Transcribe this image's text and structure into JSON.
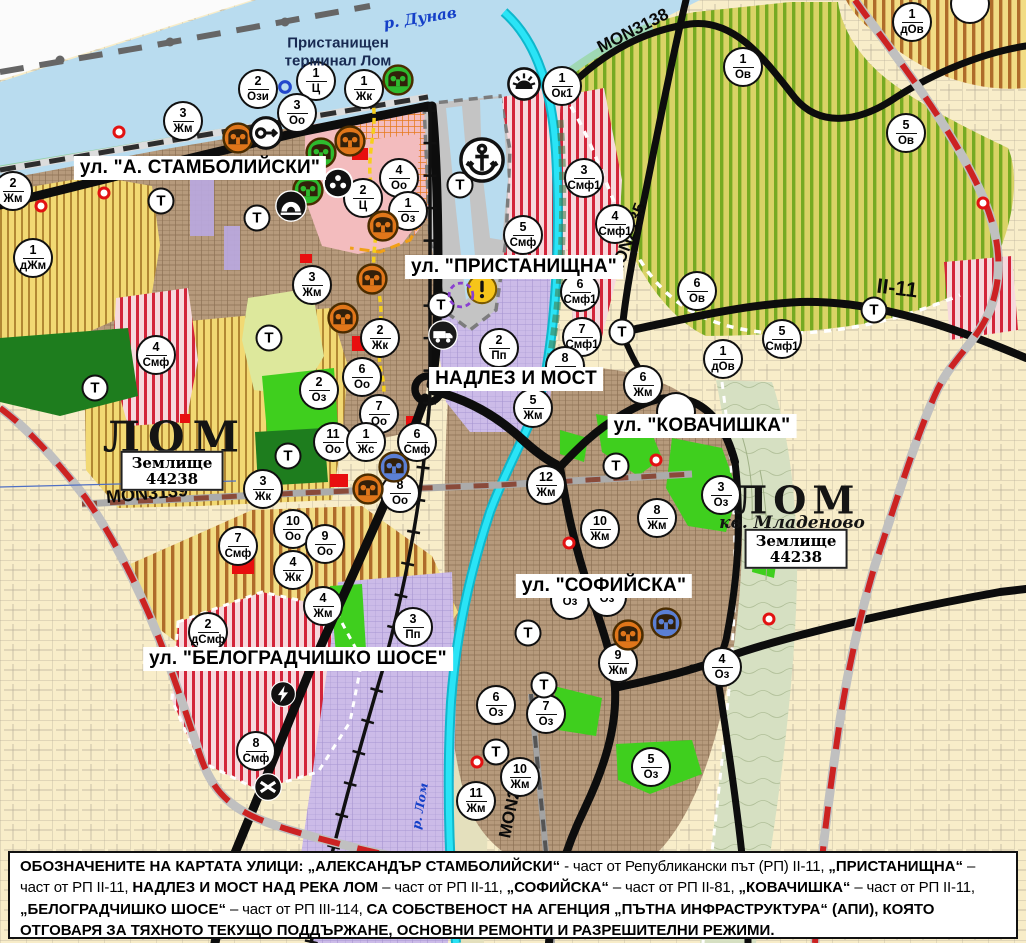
{
  "map": {
    "street_labels": [
      {
        "text": "ул. \"А. СТАМБОЛИЙСКИ\"",
        "x": 200,
        "y": 168
      },
      {
        "text": "ул. \"ПРИСТАНИЩНА\"",
        "x": 514,
        "y": 267
      },
      {
        "text": "НАДЛЕЗ И МОСТ",
        "x": 516,
        "y": 379
      },
      {
        "text": "ул. \"КОВАЧИШКА\"",
        "x": 702,
        "y": 426
      },
      {
        "text": "ул. \"СОФИЙСКА\"",
        "x": 604,
        "y": 586
      },
      {
        "text": "ул. \"БЕЛОГРАДЧИШКО ШОСЕ\"",
        "x": 298,
        "y": 659
      }
    ],
    "road_labels": [
      {
        "text": "MON3139",
        "x": 147,
        "y": 494,
        "rot": -5,
        "fs": 18
      },
      {
        "text": "MON3138",
        "x": 633,
        "y": 31,
        "rot": -27,
        "fs": 17
      },
      {
        "text": "MON2135",
        "x": 628,
        "y": 240,
        "rot": -70,
        "fs": 17
      },
      {
        "text": "MON2136",
        "x": 513,
        "y": 800,
        "rot": -78,
        "fs": 17
      },
      {
        "text": "II-11",
        "x": 897,
        "y": 289,
        "rot": 7,
        "fs": 21
      }
    ],
    "water_labels": [
      {
        "text": "р. Дунав",
        "x": 420,
        "y": 18,
        "rot": -9,
        "fs": 15
      },
      {
        "text": "р. Лом",
        "x": 420,
        "y": 806,
        "rot": -80,
        "fs": 12
      }
    ],
    "port_label": {
      "line1": "Пристанищен",
      "line2": "терминал Лом",
      "x": 338,
      "y": 52
    },
    "city_labels": [
      {
        "text": "ЛОМ",
        "x": 175,
        "y": 437,
        "fs": 42,
        "ls": 8
      },
      {
        "text": "ЛОМ",
        "x": 797,
        "y": 500,
        "fs": 38,
        "ls": 6
      }
    ],
    "district_label": {
      "text": "кв. Младеново",
      "x": 792,
      "y": 523,
      "fs": 17
    },
    "landunit_boxes": [
      {
        "line1": "Землище",
        "line2": "44238",
        "x": 172,
        "y": 471
      },
      {
        "line1": "Землище",
        "line2": "44238",
        "x": 796,
        "y": 549
      }
    ],
    "terrain_label": "Т",
    "terrain_markers": [
      {
        "x": 161,
        "y": 201
      },
      {
        "x": 257,
        "y": 218
      },
      {
        "x": 269,
        "y": 338
      },
      {
        "x": 288,
        "y": 456
      },
      {
        "x": 95,
        "y": 388
      },
      {
        "x": 460,
        "y": 185
      },
      {
        "x": 441,
        "y": 305
      },
      {
        "x": 616,
        "y": 466
      },
      {
        "x": 528,
        "y": 633
      },
      {
        "x": 544,
        "y": 685
      },
      {
        "x": 496,
        "y": 752
      },
      {
        "x": 622,
        "y": 332
      },
      {
        "x": 874,
        "y": 310
      }
    ],
    "zone_markers": [
      {
        "n": "2",
        "c": "Ози",
        "x": 258,
        "y": 89
      },
      {
        "n": "1",
        "c": "Ц",
        "x": 316,
        "y": 81
      },
      {
        "n": "1",
        "c": "Жк",
        "x": 364,
        "y": 89
      },
      {
        "n": "3",
        "c": "Оо",
        "x": 297,
        "y": 113
      },
      {
        "n": "3",
        "c": "Жм",
        "x": 183,
        "y": 121
      },
      {
        "n": "2",
        "c": "Жм",
        "x": 13,
        "y": 191
      },
      {
        "n": "1",
        "c": "дЖм",
        "x": 33,
        "y": 258
      },
      {
        "n": "4",
        "c": "Оо",
        "x": 399,
        "y": 178
      },
      {
        "n": "2",
        "c": "Ц",
        "x": 363,
        "y": 198
      },
      {
        "n": "1",
        "c": "Оз",
        "x": 408,
        "y": 211
      },
      {
        "n": "1",
        "c": "Ок1",
        "x": 562,
        "y": 86
      },
      {
        "n": "3",
        "c": "Смф1",
        "x": 584,
        "y": 178
      },
      {
        "n": "4",
        "c": "Смф1",
        "x": 615,
        "y": 224
      },
      {
        "n": "5",
        "c": "Смф",
        "x": 523,
        "y": 235
      },
      {
        "n": "6",
        "c": "Смф1",
        "x": 580,
        "y": 292
      },
      {
        "n": "7",
        "c": "Смф1",
        "x": 582,
        "y": 337
      },
      {
        "n": "8",
        "c": "Жм",
        "x": 565,
        "y": 366
      },
      {
        "n": "2",
        "c": "Пп",
        "x": 499,
        "y": 348
      },
      {
        "n": "1",
        "c": "Ов",
        "x": 743,
        "y": 67
      },
      {
        "n": "5",
        "c": "Ов",
        "x": 906,
        "y": 133
      },
      {
        "n": "1",
        "c": "дОв",
        "x": 912,
        "y": 22
      },
      {
        "n": "6",
        "c": "Ов",
        "x": 697,
        "y": 291
      },
      {
        "n": "1",
        "c": "дОв",
        "x": 723,
        "y": 359
      },
      {
        "n": "5",
        "c": "Смф1",
        "x": 782,
        "y": 339
      },
      {
        "n": "2",
        "c": "Оз",
        "x": 319,
        "y": 390
      },
      {
        "n": "3",
        "c": "Жм",
        "x": 312,
        "y": 285
      },
      {
        "n": "2",
        "c": "Жк",
        "x": 380,
        "y": 338
      },
      {
        "n": "6",
        "c": "Оо",
        "x": 362,
        "y": 377
      },
      {
        "n": "7",
        "c": "Оо",
        "x": 379,
        "y": 414
      },
      {
        "n": "11",
        "c": "Оо",
        "x": 333,
        "y": 442
      },
      {
        "n": "1",
        "c": "Жс",
        "x": 366,
        "y": 442
      },
      {
        "n": "6",
        "c": "Смф",
        "x": 417,
        "y": 442
      },
      {
        "n": "8",
        "c": "Оо",
        "x": 400,
        "y": 493
      },
      {
        "n": "3",
        "c": "Жк",
        "x": 263,
        "y": 489
      },
      {
        "n": "10",
        "c": "Оо",
        "x": 293,
        "y": 529
      },
      {
        "n": "9",
        "c": "Оо",
        "x": 325,
        "y": 544
      },
      {
        "n": "4",
        "c": "Жк",
        "x": 293,
        "y": 570
      },
      {
        "n": "7",
        "c": "Смф",
        "x": 238,
        "y": 546
      },
      {
        "n": "4",
        "c": "Смф",
        "x": 156,
        "y": 355
      },
      {
        "n": "2",
        "c": "дСмф",
        "x": 208,
        "y": 632
      },
      {
        "n": "8",
        "c": "Смф",
        "x": 256,
        "y": 751
      },
      {
        "n": "4",
        "c": "Жм",
        "x": 323,
        "y": 606
      },
      {
        "n": "3",
        "c": "Пп",
        "x": 413,
        "y": 627
      },
      {
        "n": "5",
        "c": "Жм",
        "x": 533,
        "y": 408
      },
      {
        "n": "12",
        "c": "Жм",
        "x": 546,
        "y": 485
      },
      {
        "n": "10",
        "c": "Жм",
        "x": 600,
        "y": 529
      },
      {
        "n": "8",
        "c": "Жм",
        "x": 657,
        "y": 518
      },
      {
        "n": "6",
        "c": "Жм",
        "x": 643,
        "y": 385
      },
      {
        "n": "3",
        "c": "Оз",
        "x": 721,
        "y": 495
      },
      {
        "n": "9",
        "c": "Жм",
        "x": 618,
        "y": 663
      },
      {
        "n": "4",
        "c": "Оз",
        "x": 722,
        "y": 667
      },
      {
        "n": "6",
        "c": "Оз",
        "x": 496,
        "y": 705
      },
      {
        "n": "7",
        "c": "Оз",
        "x": 546,
        "y": 714
      },
      {
        "n": "10",
        "c": "Жм",
        "x": 520,
        "y": 777
      },
      {
        "n": "11",
        "c": "Жм",
        "x": 476,
        "y": 801
      },
      {
        "n": "5",
        "c": "Оз",
        "x": 651,
        "y": 767
      },
      {
        "n": "",
        "c": "Оз",
        "x": 570,
        "y": 600
      },
      {
        "n": "",
        "c": "Оз",
        "x": 607,
        "y": 597
      },
      {
        "n": "",
        "c": "",
        "x": 676,
        "y": 412
      },
      {
        "n": "",
        "c": "",
        "x": 970,
        "y": 4
      }
    ],
    "icon_markers": [
      {
        "type": "monument",
        "color": "#e0761a",
        "x": 238,
        "y": 138
      },
      {
        "type": "monument",
        "color": "#e0761a",
        "x": 350,
        "y": 141
      },
      {
        "type": "monument",
        "color": "#e0761a",
        "x": 383,
        "y": 226
      },
      {
        "type": "monument",
        "color": "#e0761a",
        "x": 343,
        "y": 318
      },
      {
        "type": "monument",
        "color": "#e0761a",
        "x": 372,
        "y": 279
      },
      {
        "type": "monument",
        "color": "#e0761a",
        "x": 368,
        "y": 489
      },
      {
        "type": "monument",
        "color": "#e0761a",
        "x": 628,
        "y": 635
      },
      {
        "type": "monument",
        "color": "#2ebb2e",
        "x": 398,
        "y": 80
      },
      {
        "type": "monument",
        "color": "#2ebb2e",
        "x": 321,
        "y": 153
      },
      {
        "type": "monument",
        "color": "#2ebb2e",
        "x": 308,
        "y": 190
      },
      {
        "type": "monument",
        "color": "#5b7fd4",
        "x": 394,
        "y": 467
      },
      {
        "type": "monument",
        "color": "#5b7fd4",
        "x": 666,
        "y": 623
      },
      {
        "type": "key",
        "x": 266,
        "y": 133
      },
      {
        "type": "people",
        "x": 338,
        "y": 183
      },
      {
        "type": "cave",
        "x": 291,
        "y": 206
      },
      {
        "type": "anchor",
        "x": 482,
        "y": 160
      },
      {
        "type": "sun",
        "x": 524,
        "y": 84
      },
      {
        "type": "warning",
        "x": 482,
        "y": 289
      },
      {
        "type": "truck",
        "x": 443,
        "y": 335
      },
      {
        "type": "lightning",
        "x": 283,
        "y": 694
      },
      {
        "type": "crossing",
        "x": 268,
        "y": 787
      },
      {
        "type": "ring-blue",
        "x": 285,
        "y": 87
      },
      {
        "type": "ring-dashed",
        "x": 461,
        "y": 295
      }
    ],
    "point_markers": [
      {
        "x": 119,
        "y": 132
      },
      {
        "x": 104,
        "y": 193
      },
      {
        "x": 41,
        "y": 206
      },
      {
        "x": 656,
        "y": 460
      },
      {
        "x": 569,
        "y": 543
      },
      {
        "x": 477,
        "y": 762
      },
      {
        "x": 769,
        "y": 619
      },
      {
        "x": 983,
        "y": 203
      }
    ]
  },
  "legend_note": {
    "segments": [
      {
        "b": 1,
        "t": "ОБОЗНАЧЕНИТЕ НА КАРТАТА УЛИЦИ: „АЛЕКСАНДЪР СТАМБОЛИЙСКИ“"
      },
      {
        "b": 0,
        "t": " - част от Републикански път (РП) II-11, "
      },
      {
        "b": 1,
        "t": "„ПРИСТАНИЩНА“"
      },
      {
        "b": 0,
        "t": " – част от РП II-11, "
      },
      {
        "b": 1,
        "t": "НАДЛЕЗ И МОСТ НАД РЕКА ЛОМ"
      },
      {
        "b": 0,
        "t": " – част от РП II-11, "
      },
      {
        "b": 1,
        "t": "„СОФИЙСКА“"
      },
      {
        "b": 0,
        "t": " – част от РП II-81, "
      },
      {
        "b": 1,
        "t": "„КОВАЧИШКА“"
      },
      {
        "b": 0,
        "t": " – част от РП II-11, "
      },
      {
        "b": 1,
        "t": "„БЕЛОГРАДЧИШКО ШОСЕ“"
      },
      {
        "b": 0,
        "t": " – част от РП III-114, "
      },
      {
        "b": 1,
        "t": "СА СОБСТВЕНОСТ НА АГЕНЦИЯ „ПЪТНА ИНФРАСТРУКТУРА“ (АПИ), КОЯТО ОТГОВАРЯ ЗА ТЯХНОТО ТЕКУЩО ПОДДЪРЖАНЕ, ОСНОВНИ РЕМОНТИ И РАЗРЕШИТЕЛНИ РЕЖИМИ."
      }
    ]
  },
  "colors": {
    "water": "#b9dcef",
    "river": "#2ae4f6",
    "road": "#0d0d0d",
    "boundary_red": "#cc2222",
    "zone_yellow": "#f2d973",
    "zone_red_stripe": "#d01228",
    "zone_purple": "#ccbbe8",
    "zone_green": "#3fcf1e",
    "zone_vineyard": "#d9d366",
    "urban_tan": "#b69a7c",
    "cadastre_beige": "#f8edc9"
  }
}
